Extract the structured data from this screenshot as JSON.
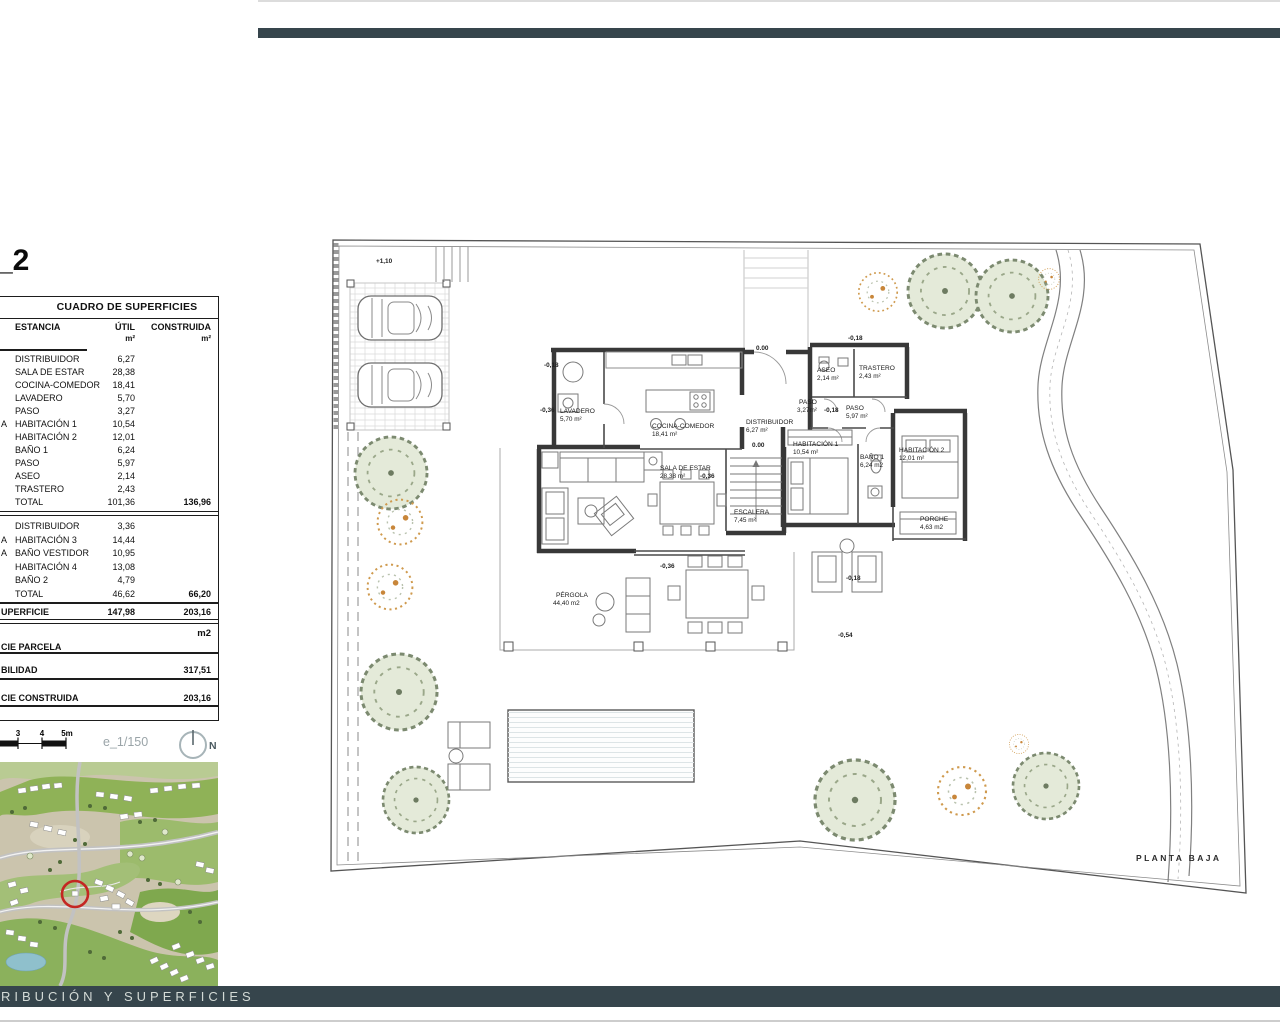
{
  "title_fragment": "_2",
  "colors": {
    "accent_bar": "#36454c",
    "map_marker_red": "#c42723",
    "tree_green": "#e4ead9",
    "shrub_orange": "#cf9a4e"
  },
  "surface_table": {
    "title": "CUADRO DE SUPERFICIES",
    "columns": {
      "estancia": "ESTANCIA",
      "util": "ÚTIL",
      "construida": "CONSTRUIDA",
      "unit": "m²"
    },
    "side_fragments": [
      "A",
      "A",
      "A"
    ],
    "group1": {
      "rows": [
        {
          "name": "DISTRIBUIDOR",
          "util": "6,27"
        },
        {
          "name": "SALA DE ESTAR",
          "util": "28,38"
        },
        {
          "name": "COCINA-COMEDOR",
          "util": "18,41"
        },
        {
          "name": "LAVADERO",
          "util": "5,70"
        },
        {
          "name": "PASO",
          "util": "3,27"
        },
        {
          "name": "HABITACIÓN 1",
          "util": "10,54"
        },
        {
          "name": "HABITACIÓN 2",
          "util": "12,01"
        },
        {
          "name": "BAÑO 1",
          "util": "6,24"
        },
        {
          "name": "PASO",
          "util": "5,97"
        },
        {
          "name": "ASEO",
          "util": "2,14"
        },
        {
          "name": "TRASTERO",
          "util": "2,43"
        }
      ],
      "total": {
        "name": "TOTAL",
        "util": "101,36",
        "construida": "136,96"
      }
    },
    "group2": {
      "rows": [
        {
          "name": "DISTRIBUIDOR",
          "util": "3,36"
        },
        {
          "name": "HABITACIÓN 3",
          "util": "14,44"
        },
        {
          "name": "BAÑO VESTIDOR",
          "util": "10,95"
        },
        {
          "name": "HABITACIÓN 4",
          "util": "13,08"
        },
        {
          "name": "BAÑO 2",
          "util": "4,79"
        }
      ],
      "total": {
        "name": "TOTAL",
        "util": "46,62",
        "construida": "66,20"
      }
    },
    "superficie": {
      "name": "UPERFICIE",
      "util": "147,98",
      "construida": "203,16"
    },
    "unit_note": "m2",
    "parcela_label": "CIE PARCELA",
    "edificabilidad": {
      "name": "BILIDAD",
      "value": "317,51"
    },
    "construida_total": {
      "name": "CIE CONSTRUIDA",
      "value": "203,16"
    }
  },
  "scale_bar": {
    "tick3": "3",
    "tick4": "4",
    "tick5": "5m",
    "scale_text": "e_1/150",
    "north_label": "N"
  },
  "plan": {
    "caption": "PLANTA BAJA",
    "rooms": {
      "lavadero": {
        "name": "LAVADERO",
        "area": "5,70  m²"
      },
      "cocina": {
        "name": "COCINA-COMEDOR",
        "area": "18,41 m²"
      },
      "distribuidor": {
        "name": "DISTRIBUIDOR",
        "area": "6,27 m²"
      },
      "sala": {
        "name": "SALA DE  ESTAR",
        "area": "28,38 m²"
      },
      "escalera": {
        "name": "ESCALERA",
        "area": "7,45 m²"
      },
      "aseo": {
        "name": "ASEO",
        "area": "2,14 m²"
      },
      "trastero": {
        "name": "TRASTERO",
        "area": "2,43 m²"
      },
      "paso1": {
        "name": "PASO",
        "area": "3,27m²"
      },
      "paso2": {
        "name": "PASO",
        "area": "5,97 m²"
      },
      "hab1": {
        "name": "HABITACIÓN 1",
        "area": "10,54 m²"
      },
      "bano1": {
        "name": "BAÑO 1",
        "area": "6,24 m2"
      },
      "hab2": {
        "name": "HABITACIÓN 2",
        "area": "12,01 m²"
      },
      "porche": {
        "name": "PORCHE",
        "area": "4,63 m2"
      },
      "pergola": {
        "name": "PÉRGOLA",
        "area": "44,40 m2"
      }
    },
    "levels": {
      "carport": "+1,10",
      "left_upper": "-0,18",
      "left_lower": "-0,36",
      "entry_top": "0.00",
      "entry_inner": "0.00",
      "aseo_top": "-0,18",
      "paso": "-0,18",
      "sala": "-0,36",
      "pergola": "-0,36",
      "terrace_right": "-0,18",
      "terrace_low": "-0,54"
    }
  },
  "footer": {
    "title": "RIBUCIÓN Y SUPERFICIES"
  }
}
